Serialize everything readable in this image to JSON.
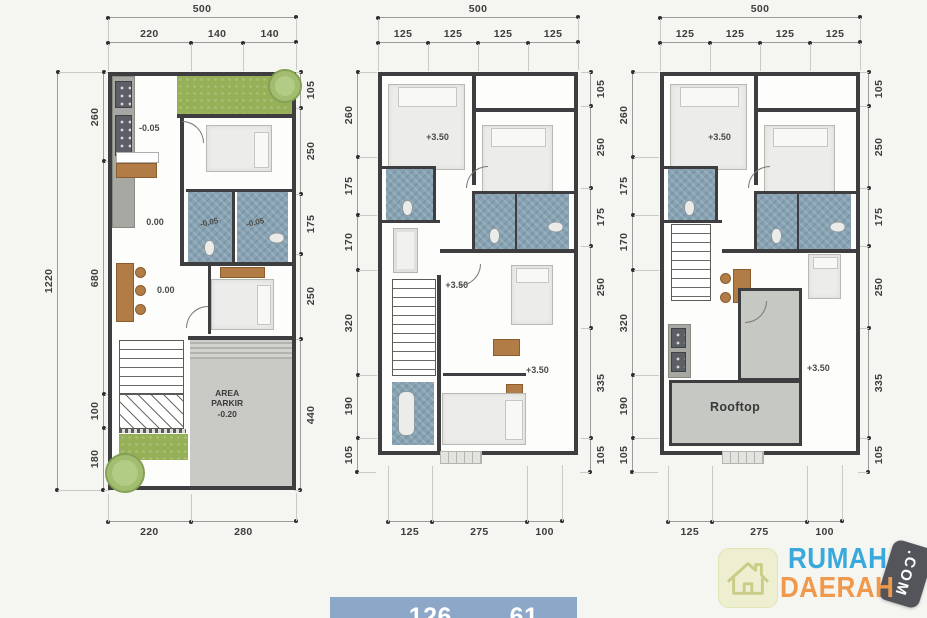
{
  "colors": {
    "background": "#f5f5f2",
    "wall": "#3e3e40",
    "bath_tile": "#87a2b2",
    "garden_green": "#96b057",
    "wood": "#b17c46",
    "parking_gray": "#c9cac6",
    "roof_gray": "#c6c8c3",
    "banner_bg": "#8ca7c7",
    "logo_blue": "#39a8db",
    "logo_orange": "#f0994c",
    "logo_tag_bg": "#54555a",
    "logo_badge_bg": "#edefd0"
  },
  "plans": [
    {
      "id": "ground-floor",
      "top_total": "500",
      "top": [
        "220",
        "140",
        "140"
      ],
      "left_total": "1220",
      "left": [
        "260",
        "680",
        "100",
        "180"
      ],
      "right": [
        "105",
        "250",
        "175",
        "250",
        "440"
      ],
      "bottom": [
        "220",
        "280"
      ],
      "labels": {
        "kitchen_level": "-0.05",
        "living_level": "0.00",
        "dining_level": "0.00",
        "bath1_level": "-0.05",
        "bath2_level": "-0.05",
        "parking_line1": "AREA",
        "parking_line2": "PARKIR",
        "parking_line3": "-0.20"
      }
    },
    {
      "id": "second-floor",
      "top_total": "500",
      "top": [
        "125",
        "125",
        "125",
        "125"
      ],
      "left": [
        "260",
        "175",
        "170",
        "320",
        "190",
        "105"
      ],
      "right": [
        "105",
        "250",
        "175",
        "250",
        "335",
        "105"
      ],
      "bottom": [
        "125",
        "275",
        "100"
      ],
      "labels": {
        "level_a": "+3.50",
        "level_b": "+3.50",
        "level_c": "+3.50"
      }
    },
    {
      "id": "third-floor",
      "top_total": "500",
      "top": [
        "125",
        "125",
        "125",
        "125"
      ],
      "left": [
        "260",
        "175",
        "170",
        "320",
        "190",
        "105"
      ],
      "right": [
        "105",
        "250",
        "175",
        "250",
        "335",
        "105"
      ],
      "bottom": [
        "125",
        "275",
        "100"
      ],
      "labels": {
        "level_a": "+3.50",
        "level_b": "+3.50",
        "rooftop": "Rooftop"
      }
    }
  ],
  "banner": {
    "area1_label": "Luas",
    "area1_value": "126",
    "area2_label": "Luas",
    "area2_value": "61"
  },
  "logo": {
    "word1": "RUMAH",
    "word2": "DAERAH",
    "tag": ".COM"
  }
}
